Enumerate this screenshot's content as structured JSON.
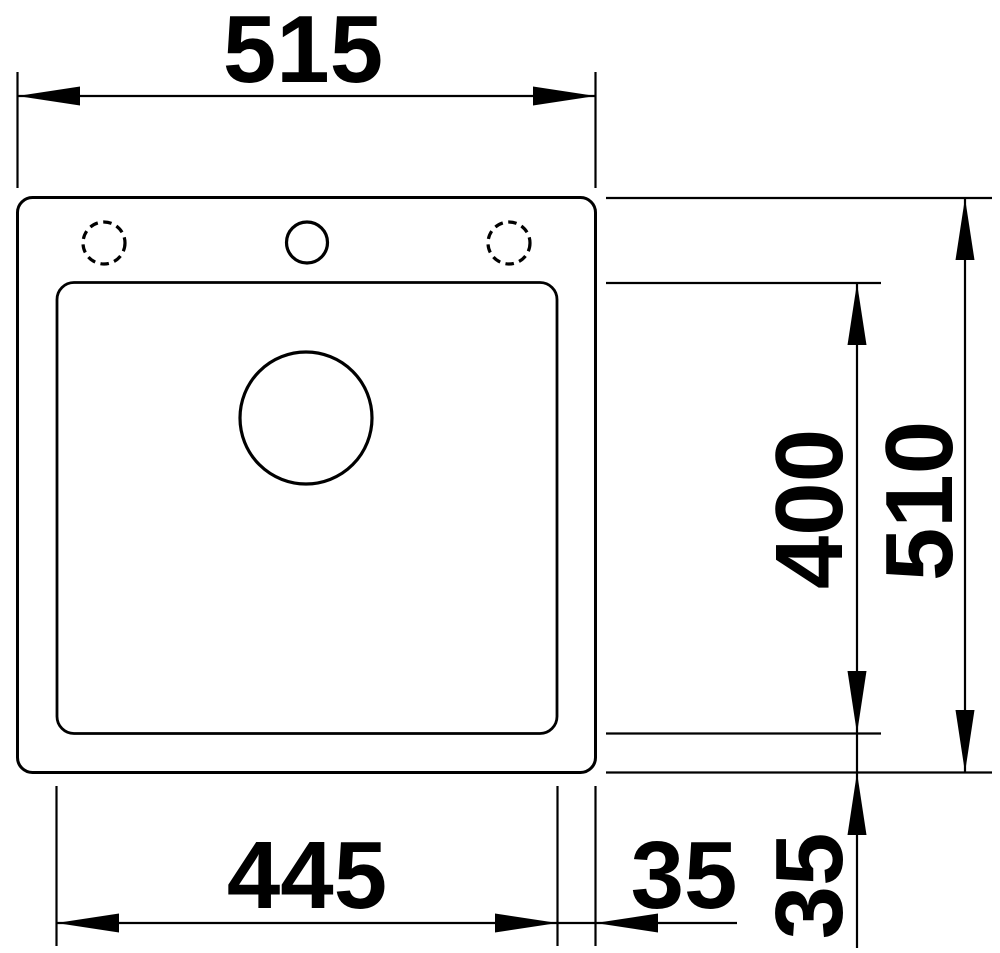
{
  "drawing": {
    "title": "Sink installation drawing, top view",
    "units": "mm",
    "colors": {
      "line": "#000000",
      "background": "#ffffff"
    },
    "dimensions": {
      "overall_width": {
        "label": "515",
        "value": 515
      },
      "overall_depth": {
        "label": "510",
        "value": 510
      },
      "bowl_depth": {
        "label": "400",
        "value": 400
      },
      "bowl_width": {
        "label": "445",
        "value": 445
      },
      "rim_offset_bottom": {
        "label": "35",
        "value": 35
      },
      "rim_offset_right": {
        "label": "35",
        "value": 35
      }
    },
    "features": {
      "tap_hole_left": "dashed-circle-optional",
      "tap_hole_center": "solid-circle",
      "tap_hole_right": "dashed-circle-optional",
      "drain_hole": "solid-circle"
    }
  }
}
